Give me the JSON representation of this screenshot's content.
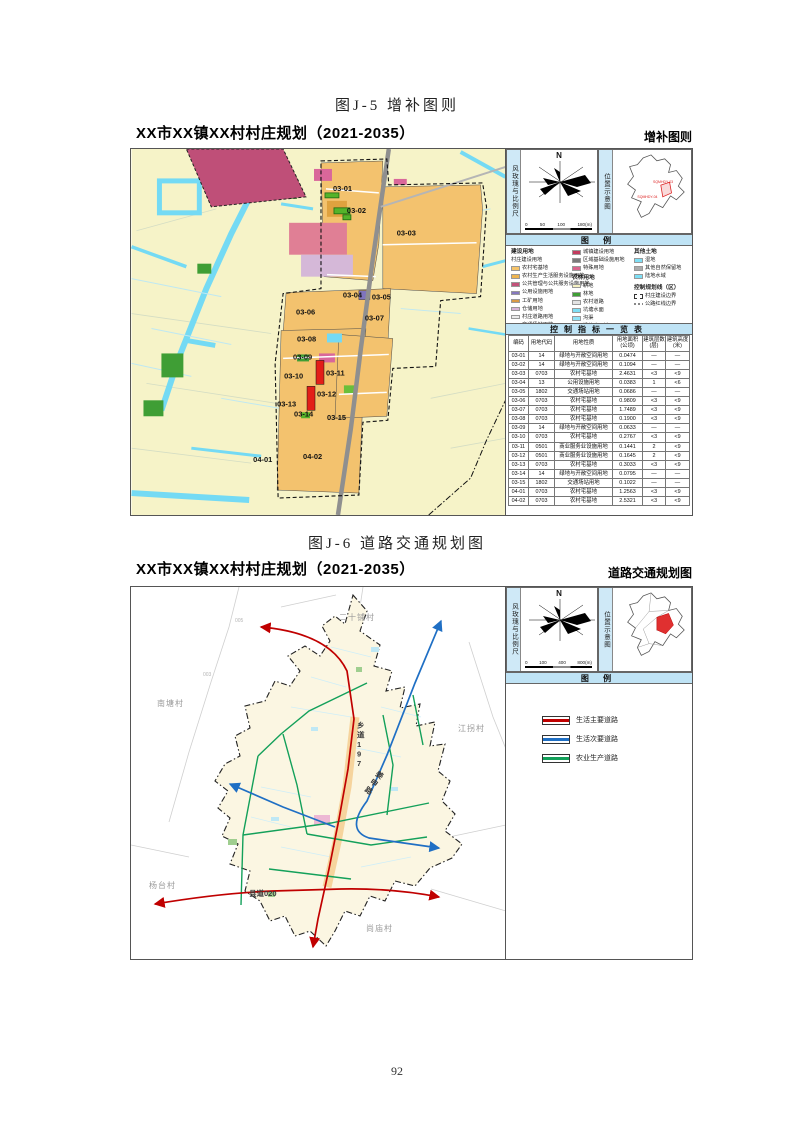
{
  "page": {
    "number": "92"
  },
  "fig1": {
    "caption": "图J-5 增补图则",
    "plan_title": "XX市XX镇XX村村庄规划（2021-2035）",
    "panel_title": "增补图则",
    "windrose_label": "风玫瑰与比例尺",
    "north": "N",
    "scale_ticks": [
      "0",
      "50",
      "100",
      "180(m)"
    ],
    "location_label": "位置示意图",
    "location_codes": [
      "SQMHDY-03",
      "SQMHDY-04"
    ],
    "legend_header": "图 例",
    "legend": {
      "col1_header": "建设用地",
      "col1_subheader": "村庄建设用地",
      "col1_items": [
        {
          "label": "农村宅基地",
          "color": "#f6c46a"
        },
        {
          "label": "农村生产生活服务设施用地",
          "color": "#eeb44f"
        },
        {
          "label": "公共管理与公共服务设施用地",
          "color": "#c2527a"
        },
        {
          "label": "公用设施用地",
          "color": "#8578bf"
        },
        {
          "label": "工矿用地",
          "color": "#d99a45"
        },
        {
          "label": "仓储用地",
          "color": "#d9b3d9"
        },
        {
          "label": "村庄道路用地",
          "color": "#ececec"
        },
        {
          "label": "交通场站用地",
          "color": "#c9c9c9"
        },
        {
          "label": "绿地与广场用地",
          "color": "#76c53d"
        }
      ],
      "col2_items_top": [
        {
          "label": "城镇建设用地",
          "color": "#c23b5e"
        },
        {
          "label": "区域基础设施用地",
          "color": "#7a7a7a"
        },
        {
          "label": "特殊用地",
          "color": "#d9648c"
        }
      ],
      "col2_header": "农林用地",
      "col2_items": [
        {
          "label": "耕地",
          "color": "#f6f2c3"
        },
        {
          "label": "林地",
          "color": "#3f9e35"
        },
        {
          "label": "农村道路",
          "color": "#e3e3e3"
        },
        {
          "label": "坑塘水面",
          "color": "#7edff5"
        },
        {
          "label": "沟渠",
          "color": "#8fe3f7"
        },
        {
          "label": "设施农用地",
          "color": "#4fd0cd"
        }
      ],
      "col3_header": "其他土地",
      "col3_items": [
        {
          "label": "湿地",
          "color": "#7edff5"
        },
        {
          "label": "其他自然保留地",
          "color": "#ababab"
        },
        {
          "label": "陆地水域",
          "color": "#7edff5"
        }
      ],
      "col3_header2": "控制规划线（区）",
      "col3_lines": [
        {
          "label": "村庄建设边界",
          "style": "dashed-box"
        },
        {
          "label": "公路红线边界",
          "style": "zigzag"
        }
      ]
    },
    "table": {
      "title": "控制指标一览表",
      "headers": [
        "编码",
        "用地代码",
        "用地性质",
        "用地面积\n(公顷)",
        "建筑层数\n(层)",
        "建筑高度\n(米)"
      ],
      "rows": [
        [
          "03-01",
          "14",
          "绿地与开敞空间用地",
          "0.0474",
          "—",
          "—"
        ],
        [
          "03-02",
          "14",
          "绿地与开敞空间用地",
          "0.1094",
          "—",
          "—"
        ],
        [
          "03-03",
          "0703",
          "农村宅基地",
          "2.4631",
          "<3",
          "<9"
        ],
        [
          "03-04",
          "13",
          "公用设施用地",
          "0.0383",
          "1",
          "<6"
        ],
        [
          "03-05",
          "1802",
          "交通场站用地",
          "0.0686",
          "—",
          "—"
        ],
        [
          "03-06",
          "0703",
          "农村宅基地",
          "0.9809",
          "<3",
          "<9"
        ],
        [
          "03-07",
          "0703",
          "农村宅基地",
          "1.7489",
          "<3",
          "<9"
        ],
        [
          "03-08",
          "0703",
          "农村宅基地",
          "0.1900",
          "<3",
          "<9"
        ],
        [
          "03-09",
          "14",
          "绿地与开敞空间用地",
          "0.0633",
          "—",
          "—"
        ],
        [
          "03-10",
          "0703",
          "农村宅基地",
          "0.2767",
          "<3",
          "<9"
        ],
        [
          "03-11",
          "0501",
          "商业服务业设施用地",
          "0.1441",
          "2",
          "<9"
        ],
        [
          "03-12",
          "0501",
          "商业服务业设施用地",
          "0.1645",
          "2",
          "<9"
        ],
        [
          "03-13",
          "0703",
          "农村宅基地",
          "0.3033",
          "<3",
          "<9"
        ],
        [
          "03-14",
          "14",
          "绿地与开敞空间用地",
          "0.0795",
          "—",
          "—"
        ],
        [
          "03-15",
          "1802",
          "交通场站用地",
          "0.1022",
          "—",
          "—"
        ],
        [
          "04-01",
          "0703",
          "农村宅基地",
          "1.2563",
          "<3",
          "<9"
        ],
        [
          "04-02",
          "0703",
          "农村宅基地",
          "2.5321",
          "<3",
          "<9"
        ]
      ]
    },
    "map_labels": [
      {
        "text": "03-01",
        "x": 202,
        "y": 42
      },
      {
        "text": "03-02",
        "x": 216,
        "y": 64
      },
      {
        "text": "03-03",
        "x": 266,
        "y": 87
      },
      {
        "text": "03-04",
        "x": 212,
        "y": 149
      },
      {
        "text": "03-05",
        "x": 241,
        "y": 151
      },
      {
        "text": "03-06",
        "x": 165,
        "y": 166
      },
      {
        "text": "03-07",
        "x": 234,
        "y": 172
      },
      {
        "text": "03-08",
        "x": 166,
        "y": 193
      },
      {
        "text": "03-09",
        "x": 162,
        "y": 211
      },
      {
        "text": "03-10",
        "x": 153,
        "y": 230
      },
      {
        "text": "03-11",
        "x": 195,
        "y": 227
      },
      {
        "text": "03-12",
        "x": 186,
        "y": 248
      },
      {
        "text": "03-13",
        "x": 146,
        "y": 258
      },
      {
        "text": "03-14",
        "x": 163,
        "y": 268
      },
      {
        "text": "03-15",
        "x": 196,
        "y": 272
      },
      {
        "text": "04-01",
        "x": 122,
        "y": 314
      },
      {
        "text": "04-02",
        "x": 172,
        "y": 311
      }
    ]
  },
  "fig2": {
    "caption": "图J-6 道路交通规划图",
    "plan_title": "XX市XX镇XX村村庄规划（2021-2035）",
    "panel_title": "道路交通规划图",
    "windrose_label": "风玫瑰与比例尺",
    "north": "N",
    "scale_ticks": [
      "0",
      "100",
      "400",
      "800(m)"
    ],
    "location_label": "位置示意图",
    "legend_header": "图 例",
    "legend_items": [
      {
        "label": "生活主要道路",
        "color": "#c00000"
      },
      {
        "label": "生活次要道路",
        "color": "#1f6fc4"
      },
      {
        "label": "农业生产道路",
        "color": "#13a05a"
      }
    ],
    "village_labels": [
      {
        "text": "二十铺村",
        "x": 208,
        "y": 33
      },
      {
        "text": "南塘村",
        "x": 26,
        "y": 119
      },
      {
        "text": "江拐村",
        "x": 327,
        "y": 144
      },
      {
        "text": "杨台村",
        "x": 18,
        "y": 301
      },
      {
        "text": "尚庙村",
        "x": 235,
        "y": 344
      }
    ],
    "road_labels": [
      {
        "text": "乡道197",
        "x": 226,
        "y": 141,
        "vertical": true
      },
      {
        "text": "姜申路",
        "x": 244,
        "y": 188,
        "vertical": true,
        "rotate": 35
      },
      {
        "text": "县道020",
        "x": 118,
        "y": 309,
        "vertical": false
      }
    ],
    "boundary_codes": [
      {
        "text": "005",
        "x": 104,
        "y": 35
      },
      {
        "text": "003",
        "x": 72,
        "y": 89
      }
    ]
  }
}
